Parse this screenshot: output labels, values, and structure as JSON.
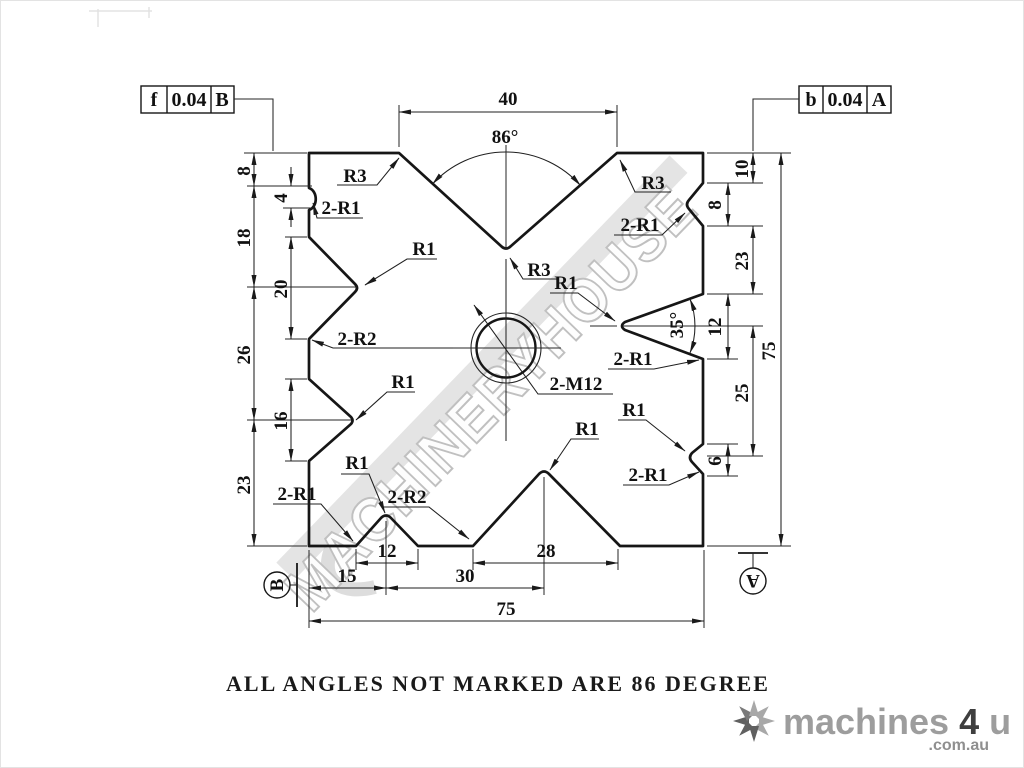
{
  "drawing": {
    "note": "ALL ANGLES NOT MARKED ARE 86 DEGREE",
    "watermark": "MACHINERYHOUSE"
  },
  "gdt": {
    "left": {
      "symbol": "f",
      "tolerance": "0.04",
      "datum": "B"
    },
    "right": {
      "symbol": "b",
      "tolerance": "0.04",
      "datum": "A"
    }
  },
  "datums": {
    "bottom_left": "B",
    "bottom_right": "A"
  },
  "dims": {
    "top_width": "40",
    "top_angle": "86°",
    "left_8": "8",
    "left_4": "4",
    "left_18": "18",
    "left_20": "20",
    "left_26": "26",
    "left_16": "16",
    "left_23": "23",
    "right_10": "10",
    "right_8": "8",
    "right_23": "23",
    "right_12": "12",
    "right_35": "35°",
    "right_25": "25",
    "right_6": "6",
    "right_75": "75",
    "bottom_12": "12",
    "bottom_28": "28",
    "bottom_15": "15",
    "bottom_30": "30",
    "bottom_75": "75"
  },
  "features": {
    "r3_top_left": "R3",
    "r3_top_right": "R3",
    "r3_apex": "R3",
    "notch_top_left": "2-R1",
    "v1_left": "R1",
    "fillets_left": "2-R2",
    "v2_left": "R1",
    "notch_bottom_left": "2-R1",
    "v_small_bottom": "R1",
    "fillets_bottom": "2-R2",
    "v_big_bottom": "R1",
    "notch_top_right": "2-R1",
    "v_right": "R1",
    "v_right_fillets": "2-R1",
    "notch_bottom_right_r1": "R1",
    "notch_bottom_right_2r1": "2-R1",
    "thread": "2-M12"
  },
  "logo": {
    "brand": "machines",
    "four": "4",
    "u": "u",
    "tld": ".com.au"
  }
}
